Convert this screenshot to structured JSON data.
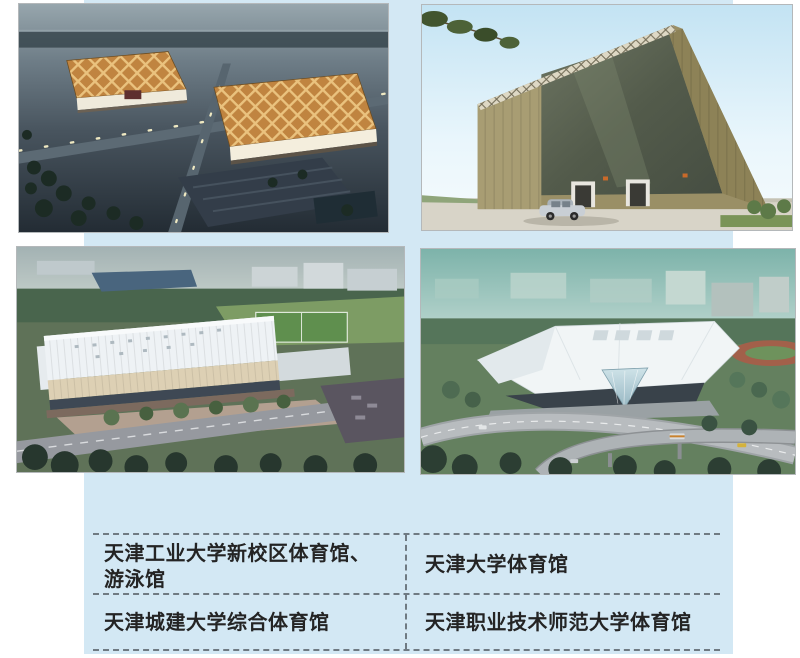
{
  "page": {
    "background_color": "#ffffff",
    "panel_color": "#d3e8f4",
    "dash_color": "#6f7a82",
    "caption_text_color": "#242424"
  },
  "captions": {
    "top_left_line1": "天津工业大学新校区体育馆、",
    "top_left_line2": "游泳馆",
    "top_right": "天津大学体育馆",
    "bottom_left": "天津城建大学综合体育馆",
    "bottom_right": "天津职业技术师范大学体育馆"
  },
  "photos": [
    {
      "position": "top-left",
      "alt": "天津工业大学新校区体育馆、游泳馆"
    },
    {
      "position": "top-right",
      "alt": "天津大学体育馆"
    },
    {
      "position": "bottom-left",
      "alt": "天津城建大学综合体育馆"
    },
    {
      "position": "bottom-right",
      "alt": "天津职业技术师范大学体育馆"
    }
  ]
}
